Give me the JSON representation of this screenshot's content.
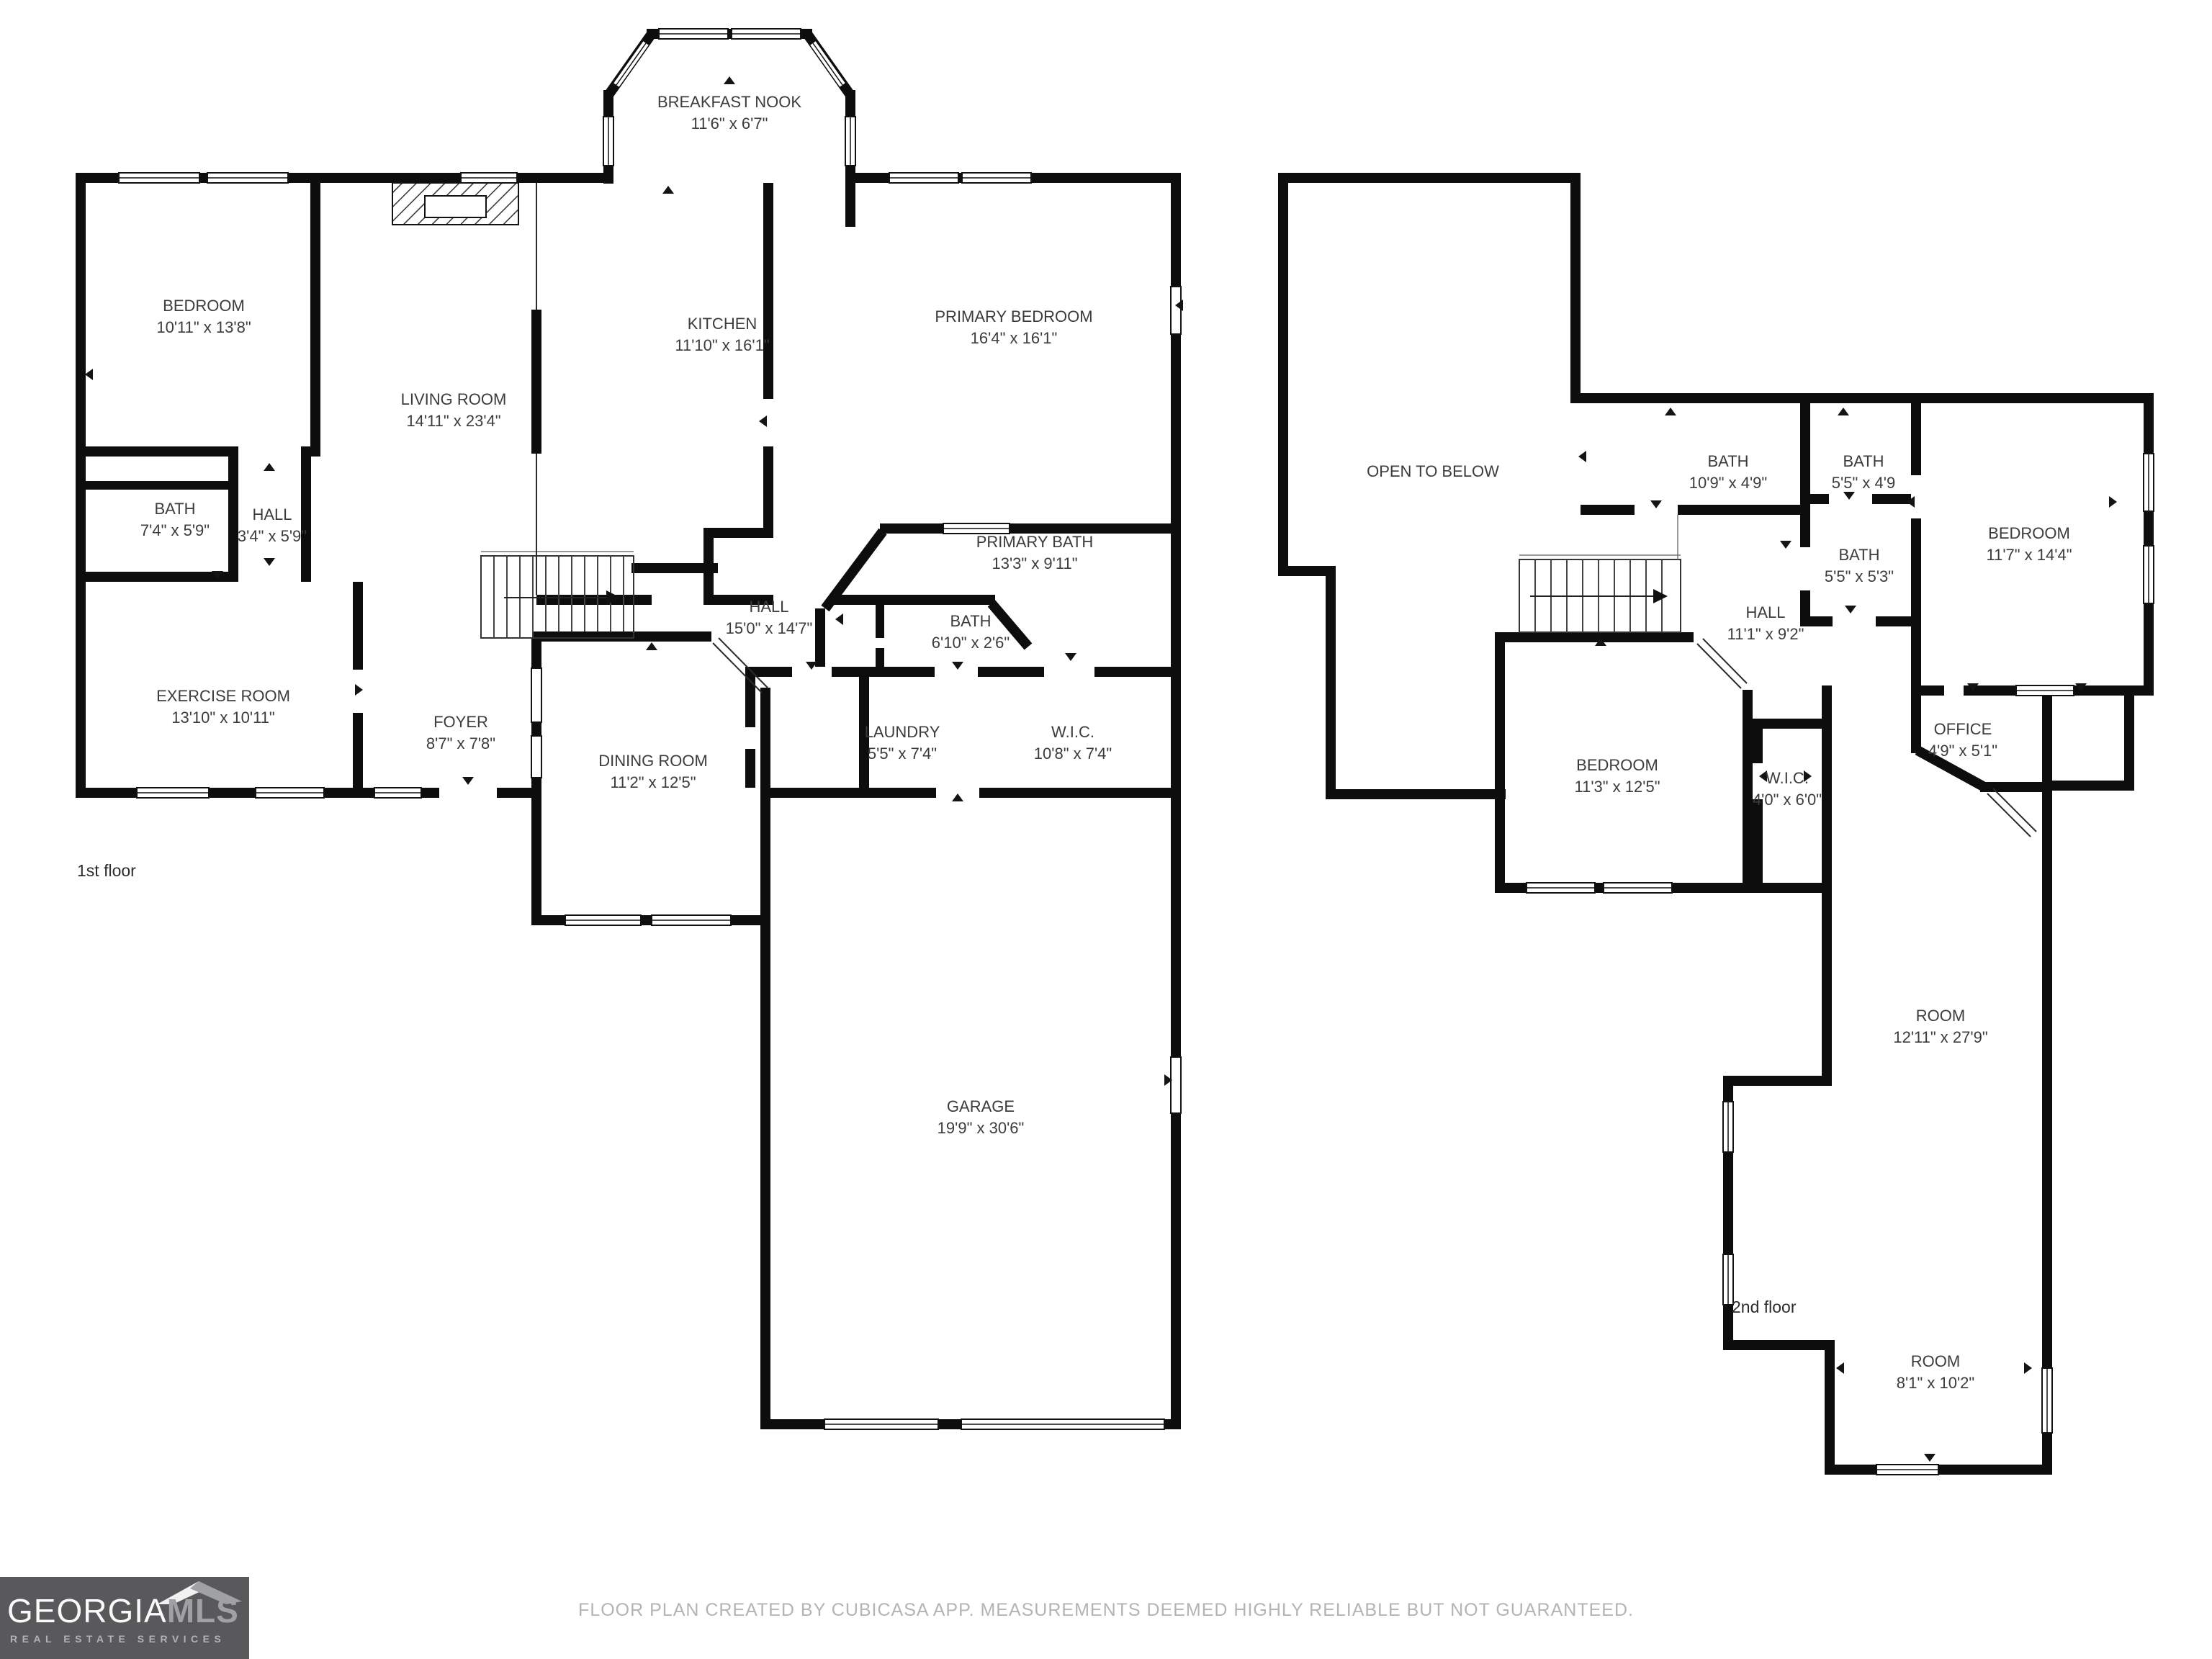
{
  "footer": {
    "text": "FLOOR PLAN CREATED BY CUBICASA APP. MEASUREMENTS DEEMED HIGHLY RELIABLE BUT NOT GUARANTEED."
  },
  "logo": {
    "brand_primary": "GEORGIA",
    "brand_secondary": "MLS",
    "tagline": "REAL ESTATE SERVICES"
  },
  "colors": {
    "wall": "#0d0d0d",
    "label_text": "#3c3c3c",
    "footer_text": "#b4b4b4",
    "logo_background": "#59595b",
    "logo_brand_secondary": "#9fa1a3"
  },
  "floor1": {
    "caption": "1st floor",
    "rooms": [
      {
        "name": "BREAKFAST NOOK",
        "dims": "11'6\" x 6'7\""
      },
      {
        "name": "BEDROOM",
        "dims": "10'11\" x 13'8\""
      },
      {
        "name": "LIVING ROOM",
        "dims": "14'11\" x 23'4\""
      },
      {
        "name": "KITCHEN",
        "dims": "11'10\" x 16'1\""
      },
      {
        "name": "PRIMARY BEDROOM",
        "dims": "16'4\" x 16'1\""
      },
      {
        "name": "BATH",
        "dims": "7'4\" x 5'9\""
      },
      {
        "name": "HALL",
        "dims": "3'4\" x 5'9\""
      },
      {
        "name": "PRIMARY BATH",
        "dims": "13'3\" x 9'11\""
      },
      {
        "name": "HALL",
        "dims": "15'0\" x 14'7\""
      },
      {
        "name": "BATH",
        "dims": "6'10\" x 2'6\""
      },
      {
        "name": "EXERCISE ROOM",
        "dims": "13'10\" x 10'11\""
      },
      {
        "name": "FOYER",
        "dims": "8'7\" x 7'8\""
      },
      {
        "name": "DINING ROOM",
        "dims": "11'2\" x 12'5\""
      },
      {
        "name": "LAUNDRY",
        "dims": "5'5\" x 7'4\""
      },
      {
        "name": "W.I.C.",
        "dims": "10'8\" x 7'4\""
      },
      {
        "name": "GARAGE",
        "dims": "19'9\" x 30'6\""
      }
    ]
  },
  "floor2": {
    "caption": "2nd floor",
    "rooms": [
      {
        "name": "OPEN TO BELOW",
        "dims": ""
      },
      {
        "name": "BATH",
        "dims": "10'9\" x 4'9\""
      },
      {
        "name": "BATH",
        "dims": "5'5\" x 4'9"
      },
      {
        "name": "BATH",
        "dims": "5'5\" x 5'3\""
      },
      {
        "name": "BEDROOM",
        "dims": "11'7\" x 14'4\""
      },
      {
        "name": "HALL",
        "dims": "11'1\" x 9'2\""
      },
      {
        "name": "BEDROOM",
        "dims": "11'3\" x 12'5\""
      },
      {
        "name": "W.I.C.",
        "dims": "4'0\" x 6'0\""
      },
      {
        "name": "OFFICE",
        "dims": "4'9\" x 5'1\""
      },
      {
        "name": "ROOM",
        "dims": "12'11\" x 27'9\""
      },
      {
        "name": "ROOM",
        "dims": "8'1\" x 10'2\""
      }
    ]
  }
}
